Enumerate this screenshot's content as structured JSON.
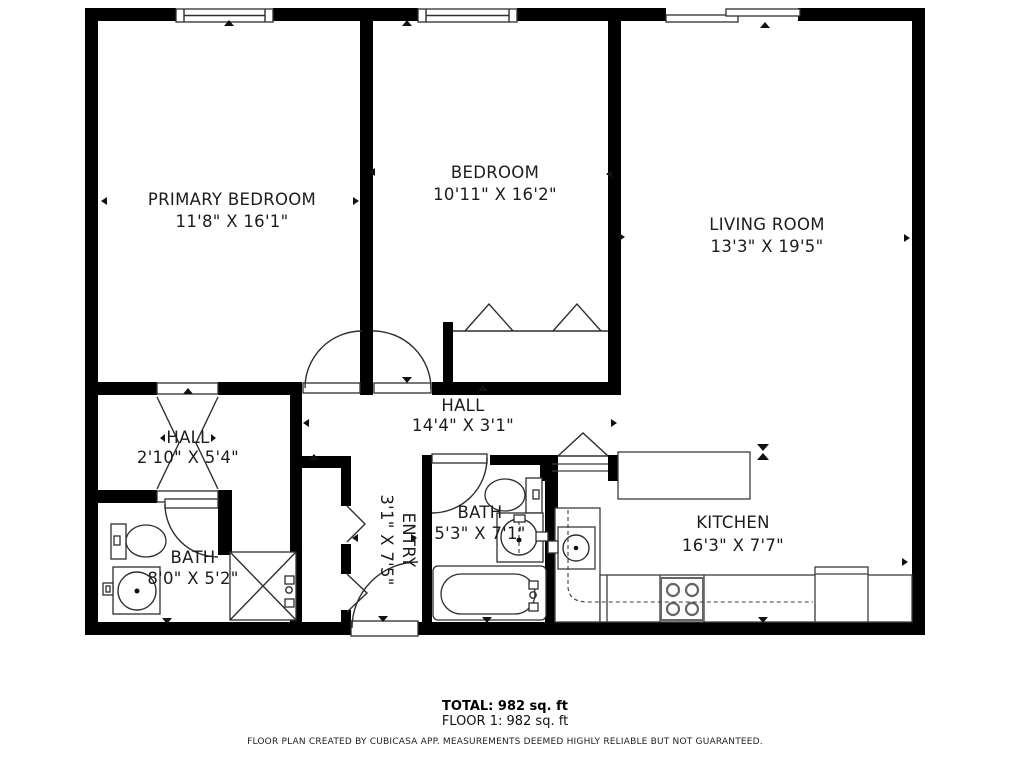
{
  "floor_plan": {
    "rooms": [
      {
        "name": "PRIMARY BEDROOM",
        "dims": "11'8\" X 16'1\""
      },
      {
        "name": "BEDROOM",
        "dims": "10'11\" X 16'2\""
      },
      {
        "name": "LIVING ROOM",
        "dims": "13'3\" X 19'5\""
      },
      {
        "name": "HALL",
        "dims": "14'4\" X 3'1\""
      },
      {
        "name": "HALL",
        "dims": "2'10\" X 5'4\""
      },
      {
        "name": "ENTRY",
        "dims": "3'1\" X 7'5\""
      },
      {
        "name": "BATH",
        "dims": "5'3\" X 7'1\""
      },
      {
        "name": "BATH",
        "dims": "8'0\" X 5'2\""
      },
      {
        "name": "KITCHEN",
        "dims": "16'3\" X 7'7\""
      }
    ],
    "summary": {
      "total": "TOTAL: 982 sq. ft",
      "floor": "FLOOR 1: 982 sq. ft"
    },
    "disclaimer": "FLOOR PLAN CREATED BY CUBICASA APP. MEASUREMENTS DEEMED HIGHLY RELIABLE BUT NOT GUARANTEED.",
    "colors": {
      "wall": "#000000",
      "fixture_line": "#2e2e2e",
      "background": "#ffffff"
    }
  }
}
